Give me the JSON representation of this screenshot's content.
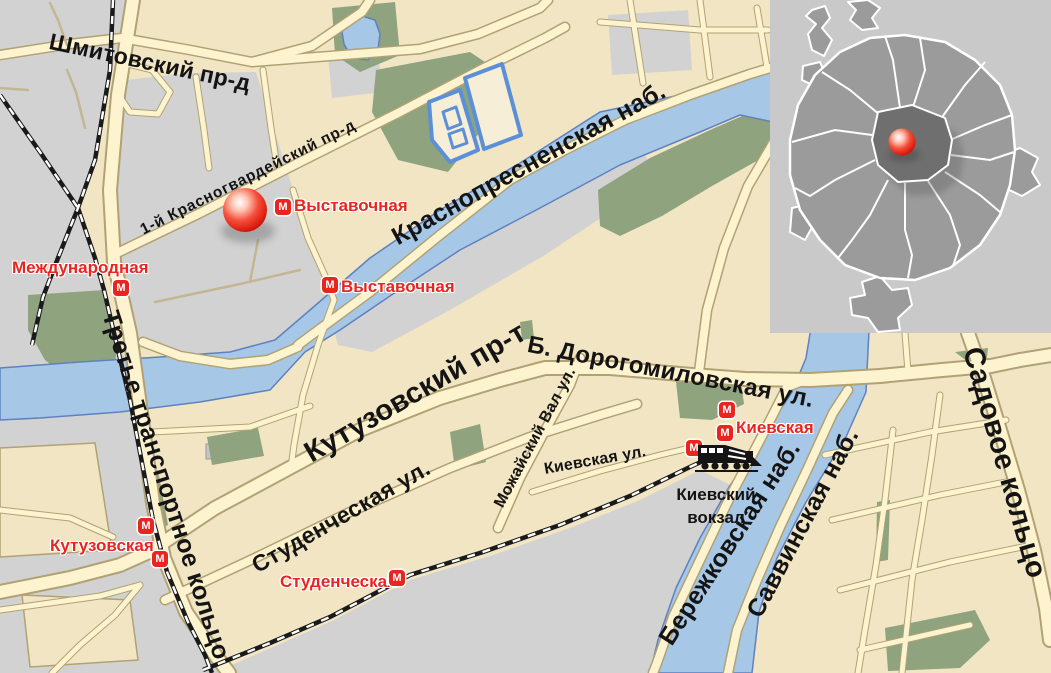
{
  "labels": {
    "streets": {
      "shmitovsky": "Шмитовский пр-д",
      "krasnogvardeysky": "1-й Красногвардейский пр-д",
      "krasnopresnenskaya": "Краснопресненская наб.",
      "kutuzovsky": "Кутузовский пр-т",
      "dorogomilovskaya": "Б. Дорогомиловская ул.",
      "studencheskaya": "Студенческая ул.",
      "mozhaysky": "Можайский Вал ул.",
      "kievskaya": "Киевская ул.",
      "ttk": "Третье транспортное кольцо",
      "berezhkovskaya": "Бережковская наб.",
      "savvinskaya": "Саввинская наб.",
      "sadovoye": "Садовое кольцо"
    },
    "stations": {
      "vystavochnaya1": "Выставочная",
      "vystavochnaya2": "Выставочная",
      "mezhdunarodnaya": "Международная",
      "kutuzovskaya": "Кутузовская",
      "studencheskaya": "Студенческая",
      "kievskaya": "Киевская"
    },
    "railway_terminal": "Киевский\nвокзал",
    "metro_glyph": "М"
  },
  "colors": {
    "background_block": "#f2e5c3",
    "secondary_zone_gray": "#d2d2d2",
    "road_fill": "#fdf3cf",
    "road_casing": "#b0a275",
    "water": "#a7c7e6",
    "water_outline": "#5f81c0",
    "park_green": "#8ea37e",
    "railway_black": "#1a1a1a",
    "metro_red": "#e8251f",
    "marker_red": "#e02517",
    "label_black": "#141414",
    "inset_background": "#c9c9c9",
    "inset_city_gray": "#9b9b9b",
    "inset_center_gray": "#6f6f6f",
    "inset_outline_white": "#ffffff"
  }
}
